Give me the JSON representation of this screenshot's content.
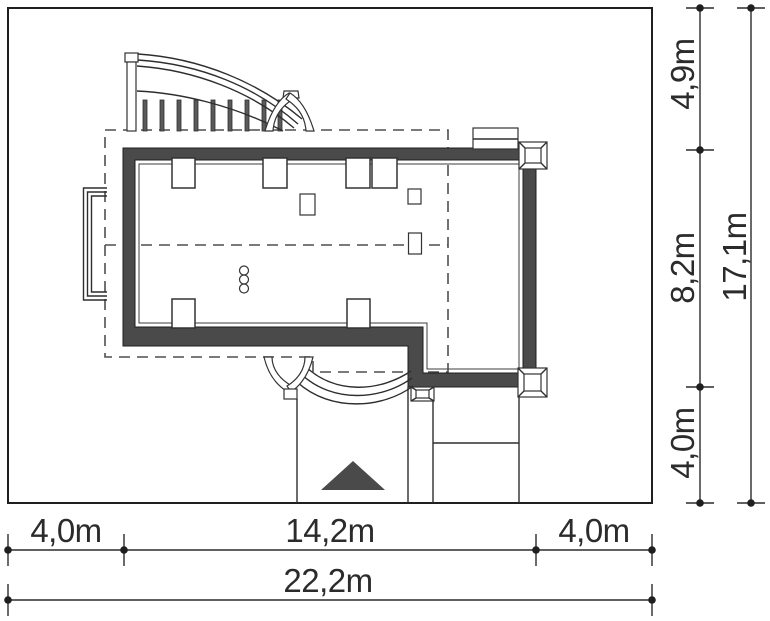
{
  "drawing": {
    "kind": "house-site-plan",
    "dimensions": {
      "bottom_left": "4,0m",
      "bottom_middle": "14,2m",
      "bottom_right": "4,0m",
      "bottom_total": "22,2m",
      "right_top": "4,9m",
      "right_middle": "8,2m",
      "right_bottom": "4,0m",
      "right_total": "17,1m"
    }
  },
  "colors": {
    "wall": "#4a4a4a",
    "arrow": "#4a4a4a",
    "line": "#2e2e2e",
    "dash": "#4f4f4f",
    "background": "#ffffff",
    "dim_text": "#2b2b2b"
  }
}
